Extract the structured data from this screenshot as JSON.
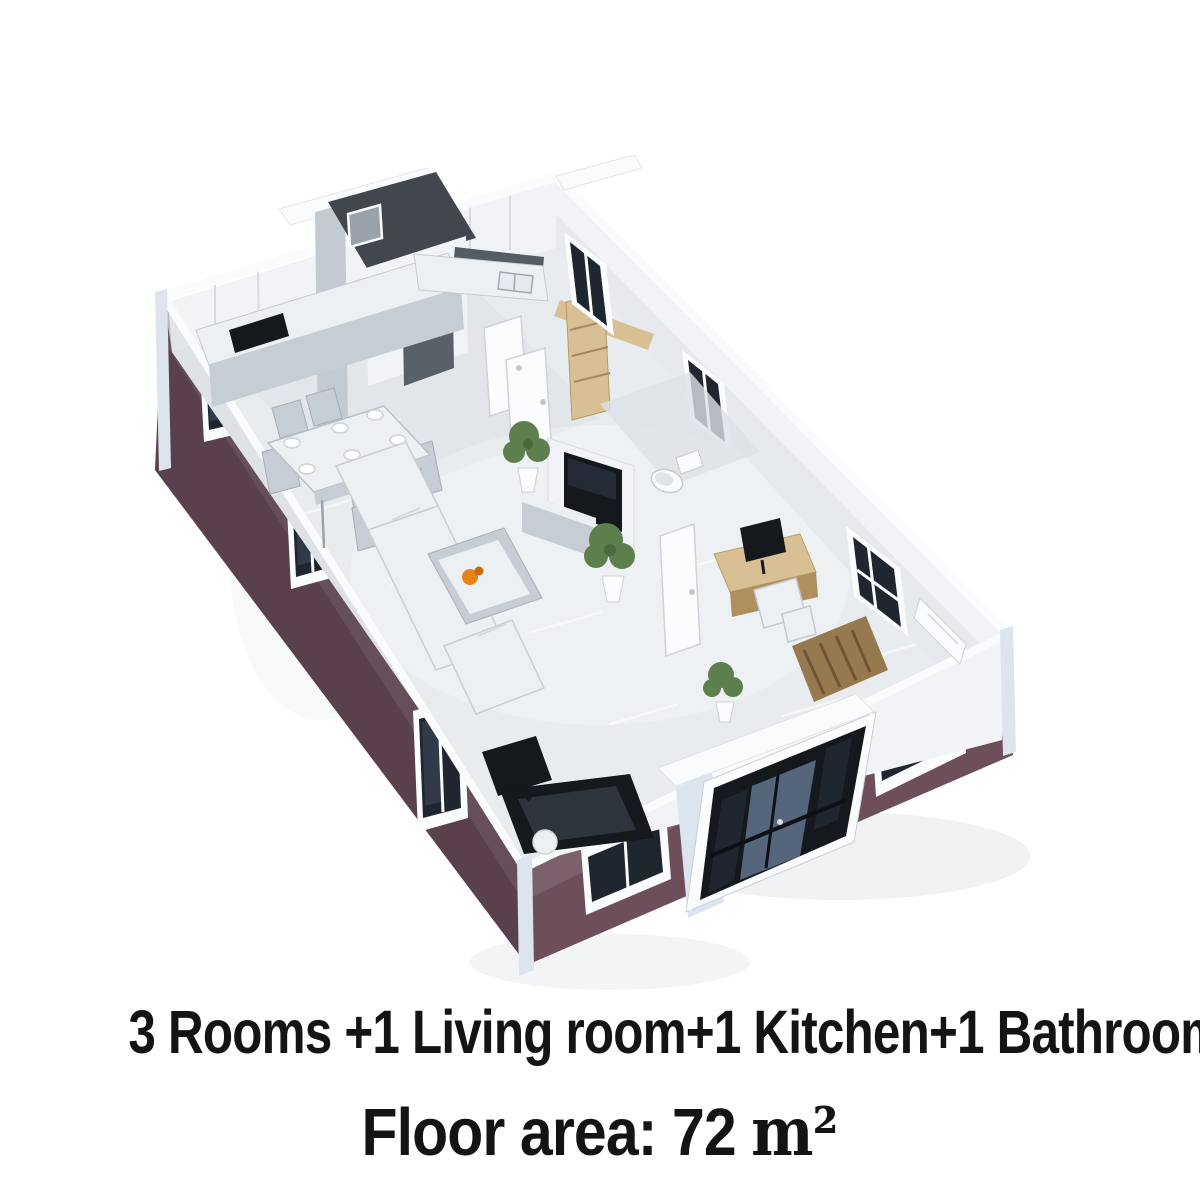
{
  "image": {
    "width": 1200,
    "height": 1200,
    "kind": "3d-floor-plan-render"
  },
  "captions": {
    "line1": "3 Rooms +1 Living room+1 Kitchen+1 Bathroom",
    "line2_label": "Floor area: 72",
    "line2_unit": "m²"
  },
  "colors": {
    "background": "#ffffff",
    "text": "#141414",
    "wall_maroon": "#6e4e5b",
    "wall_maroon_dark": "#5a3f4c",
    "wall_top_white": "#fafbfd",
    "wall_interior": "#f1f3f6",
    "wall_shade": "#d9dee4",
    "wall_shade_dark": "#c3cad2",
    "floor": "#e9ecef",
    "floor_shade": "#dde1e6",
    "dark_room": "#42474f",
    "dark_room_light": "#5a6068",
    "window_glass": "#20262f",
    "glass_reflection": "#4a5a70",
    "frame_white": "#fbfcfe",
    "wood": "#d9c094",
    "wood_dark": "#ae8f5d",
    "rug_brown": "#97794f",
    "plant_green": "#5d7f4e",
    "plant_green_dark": "#455f39",
    "accent_orange": "#e8821a",
    "furniture_gray": "#c7cdd4",
    "furniture_light": "#edf0f3",
    "black": "#15181d",
    "corner_trim": "#dce5ed"
  },
  "scene": {
    "view": "isometric cutaway of rectangular container home",
    "rooms": [
      "kitchen",
      "dining-area",
      "living-room",
      "hallway",
      "bathroom",
      "dark-utility-room",
      "study-bedroom",
      "entrance-porch"
    ],
    "objects": [
      "kitchen-counter",
      "cooktop",
      "kitchen-sink",
      "dining-table",
      "dining-chairs",
      "plates",
      "wardrobe-shelf",
      "toilet",
      "open-doors",
      "potted-plants",
      "wall-tv",
      "tv-bench",
      "sectional-sofa",
      "coffee-table",
      "orange-ornament",
      "treadmill",
      "white-ball",
      "study-desk",
      "computer-monitor",
      "desk-chair",
      "striped-rug",
      "air-conditioner",
      "glass-entrance-doors",
      "framed-windows"
    ]
  }
}
